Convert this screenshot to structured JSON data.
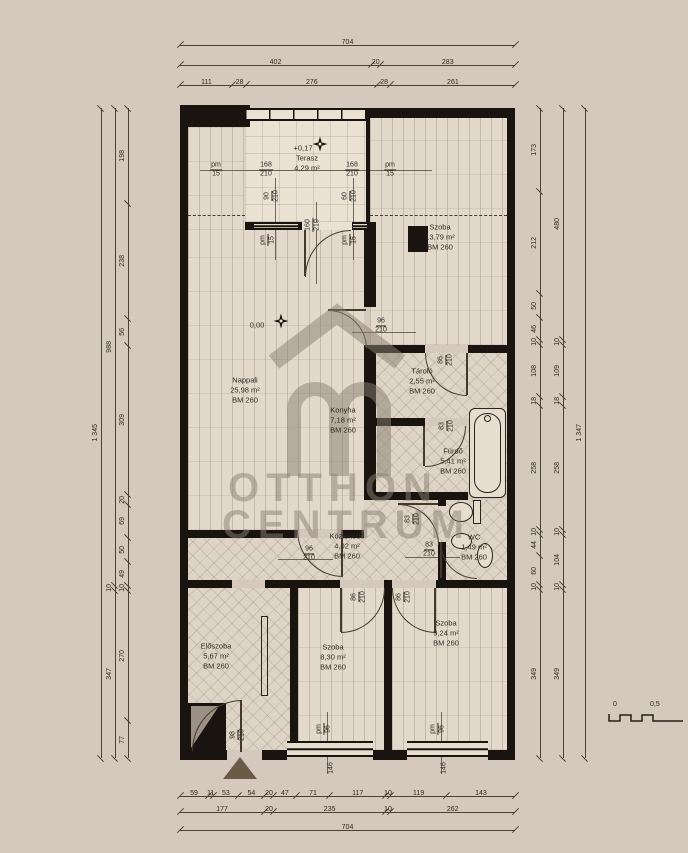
{
  "levels": {
    "terrace": "+0,17",
    "main": "0,00"
  },
  "rooms": {
    "terasz": {
      "name": "Terasz",
      "area": "4,29 m²",
      "bm": ""
    },
    "szoba1": {
      "name": "Szoba",
      "area": "13,79 m²",
      "bm": "BM 260"
    },
    "nappali": {
      "name": "Nappali",
      "area": "25,98 m²",
      "bm": "BM 260"
    },
    "konyha": {
      "name": "Konyha",
      "area": "7,18 m²",
      "bm": "BM 260"
    },
    "tarolo": {
      "name": "Tároló",
      "area": "2,55 m²",
      "bm": "BM 260"
    },
    "furdo": {
      "name": "Fürdő",
      "area": "5,41 m²",
      "bm": "BM 260"
    },
    "wc": {
      "name": "WC",
      "area": "1,49 m²",
      "bm": "BM 260"
    },
    "kozlekedo": {
      "name": "Közlekedő",
      "area": "4,02 m²",
      "bm": "BM 260"
    },
    "eloszoba": {
      "name": "Előszoba",
      "area": "5,67 m²",
      "bm": "BM 260"
    },
    "szoba2": {
      "name": "Szoba",
      "area": "8,30 m²",
      "bm": "BM 260"
    },
    "szoba3": {
      "name": "Szoba",
      "area": "9,24 m²",
      "bm": "BM 260"
    }
  },
  "openings": {
    "pm15_left": {
      "w": "pm",
      "h": "15"
    },
    "t168_left": {
      "w": "168",
      "h": "210"
    },
    "t168_right": {
      "w": "168",
      "h": "210"
    },
    "pm15_right": {
      "w": "pm",
      "h": "15"
    },
    "win90": {
      "w": "90",
      "h": "210"
    },
    "door160": {
      "w": "160",
      "h": "210"
    },
    "win60": {
      "w": "60",
      "h": "210"
    },
    "pm15_in_left": {
      "w": "pm",
      "h": "15"
    },
    "pm15_in_right": {
      "w": "pm",
      "h": "15"
    },
    "door96_szoba": {
      "w": "96",
      "h": "210"
    },
    "door86_tarolo": {
      "w": "86",
      "h": "210"
    },
    "door83_furdo": {
      "w": "83",
      "h": "210"
    },
    "door83_wc_a": {
      "w": "83",
      "h": "210"
    },
    "door83_wc_b": {
      "w": "83",
      "h": "210"
    },
    "door96_hall": {
      "w": "96",
      "h": "210"
    },
    "door86_szoba2": {
      "w": "86",
      "h": "210"
    },
    "door86_szoba3": {
      "w": "86",
      "h": "210"
    },
    "door98_entry": {
      "w": "98",
      "h": "210"
    },
    "pm96_win1": {
      "w": "pm",
      "h": "96"
    },
    "pm96_win2": {
      "w": "pm",
      "h": "96"
    },
    "win1_len": {
      "v": "146"
    },
    "win2_len": {
      "v": "146"
    }
  },
  "dims": {
    "top": {
      "row1": [
        "704"
      ],
      "row2": [
        "402",
        "20",
        "283"
      ],
      "row3": [
        "111",
        "28",
        "276",
        "28",
        "261"
      ]
    },
    "bottom": {
      "row1": [
        "59",
        "11",
        "53",
        "54",
        "20",
        "47",
        "71",
        "117",
        "10",
        "119",
        "143"
      ],
      "row2": [
        "177",
        "20",
        "235",
        "10",
        "262"
      ],
      "row3": [
        "704"
      ]
    },
    "left": {
      "outer": [
        "1 345"
      ],
      "mid": [
        "988",
        "10",
        "347"
      ],
      "inner": [
        "198",
        "238",
        "56",
        "309",
        "20",
        "69",
        "50",
        "49",
        "10",
        "270",
        "77"
      ]
    },
    "right": {
      "inner": [
        "173",
        "212",
        "50",
        "46",
        "10",
        "108",
        "18",
        "258",
        "10",
        "44",
        "60",
        "10",
        "349"
      ],
      "mid": [
        "480",
        "10",
        "109",
        "18",
        "258",
        "10",
        "104",
        "10",
        "349"
      ],
      "outer": [
        "1 347"
      ]
    }
  },
  "watermark": {
    "line1": "OTTHON",
    "line2": "CENTRUM"
  },
  "scalebar": {
    "zero": "0",
    "half": "0,5"
  }
}
